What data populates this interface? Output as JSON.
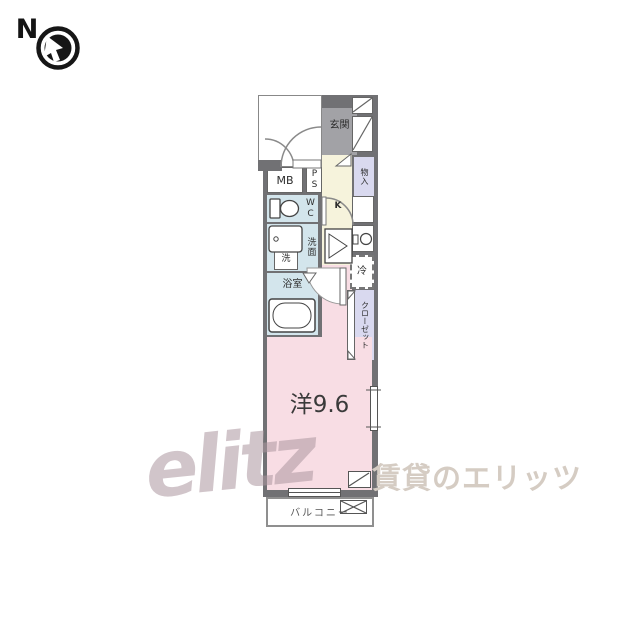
{
  "compass": {
    "label": "N"
  },
  "plan": {
    "rooms": {
      "genkan": {
        "label": "玄関"
      },
      "storage": {
        "label": "物入"
      },
      "meter_box": {
        "label": "MB"
      },
      "pipe_space": {
        "label": "PS"
      },
      "toilet": {
        "label": "WC"
      },
      "washroom": {
        "label": "洗面"
      },
      "washer": {
        "label": "洗"
      },
      "bathroom": {
        "label": "浴室"
      },
      "kitchen": {
        "label": "K"
      },
      "fridge": {
        "label": "冷"
      },
      "closet": {
        "label": "クローゼット"
      },
      "living": {
        "label": "洋9.6"
      },
      "balcony": {
        "label": "バルコニー"
      }
    },
    "colors": {
      "wall": "#717174",
      "living": "#f8dde4",
      "kitchen": "#f6f3dc",
      "wet_area": "#d3e5ec",
      "closet": "#d9d9ef",
      "genkan": "#a2a2a6"
    }
  },
  "watermark": {
    "logo": "elitz",
    "text": "賃貸のエリッツ"
  }
}
